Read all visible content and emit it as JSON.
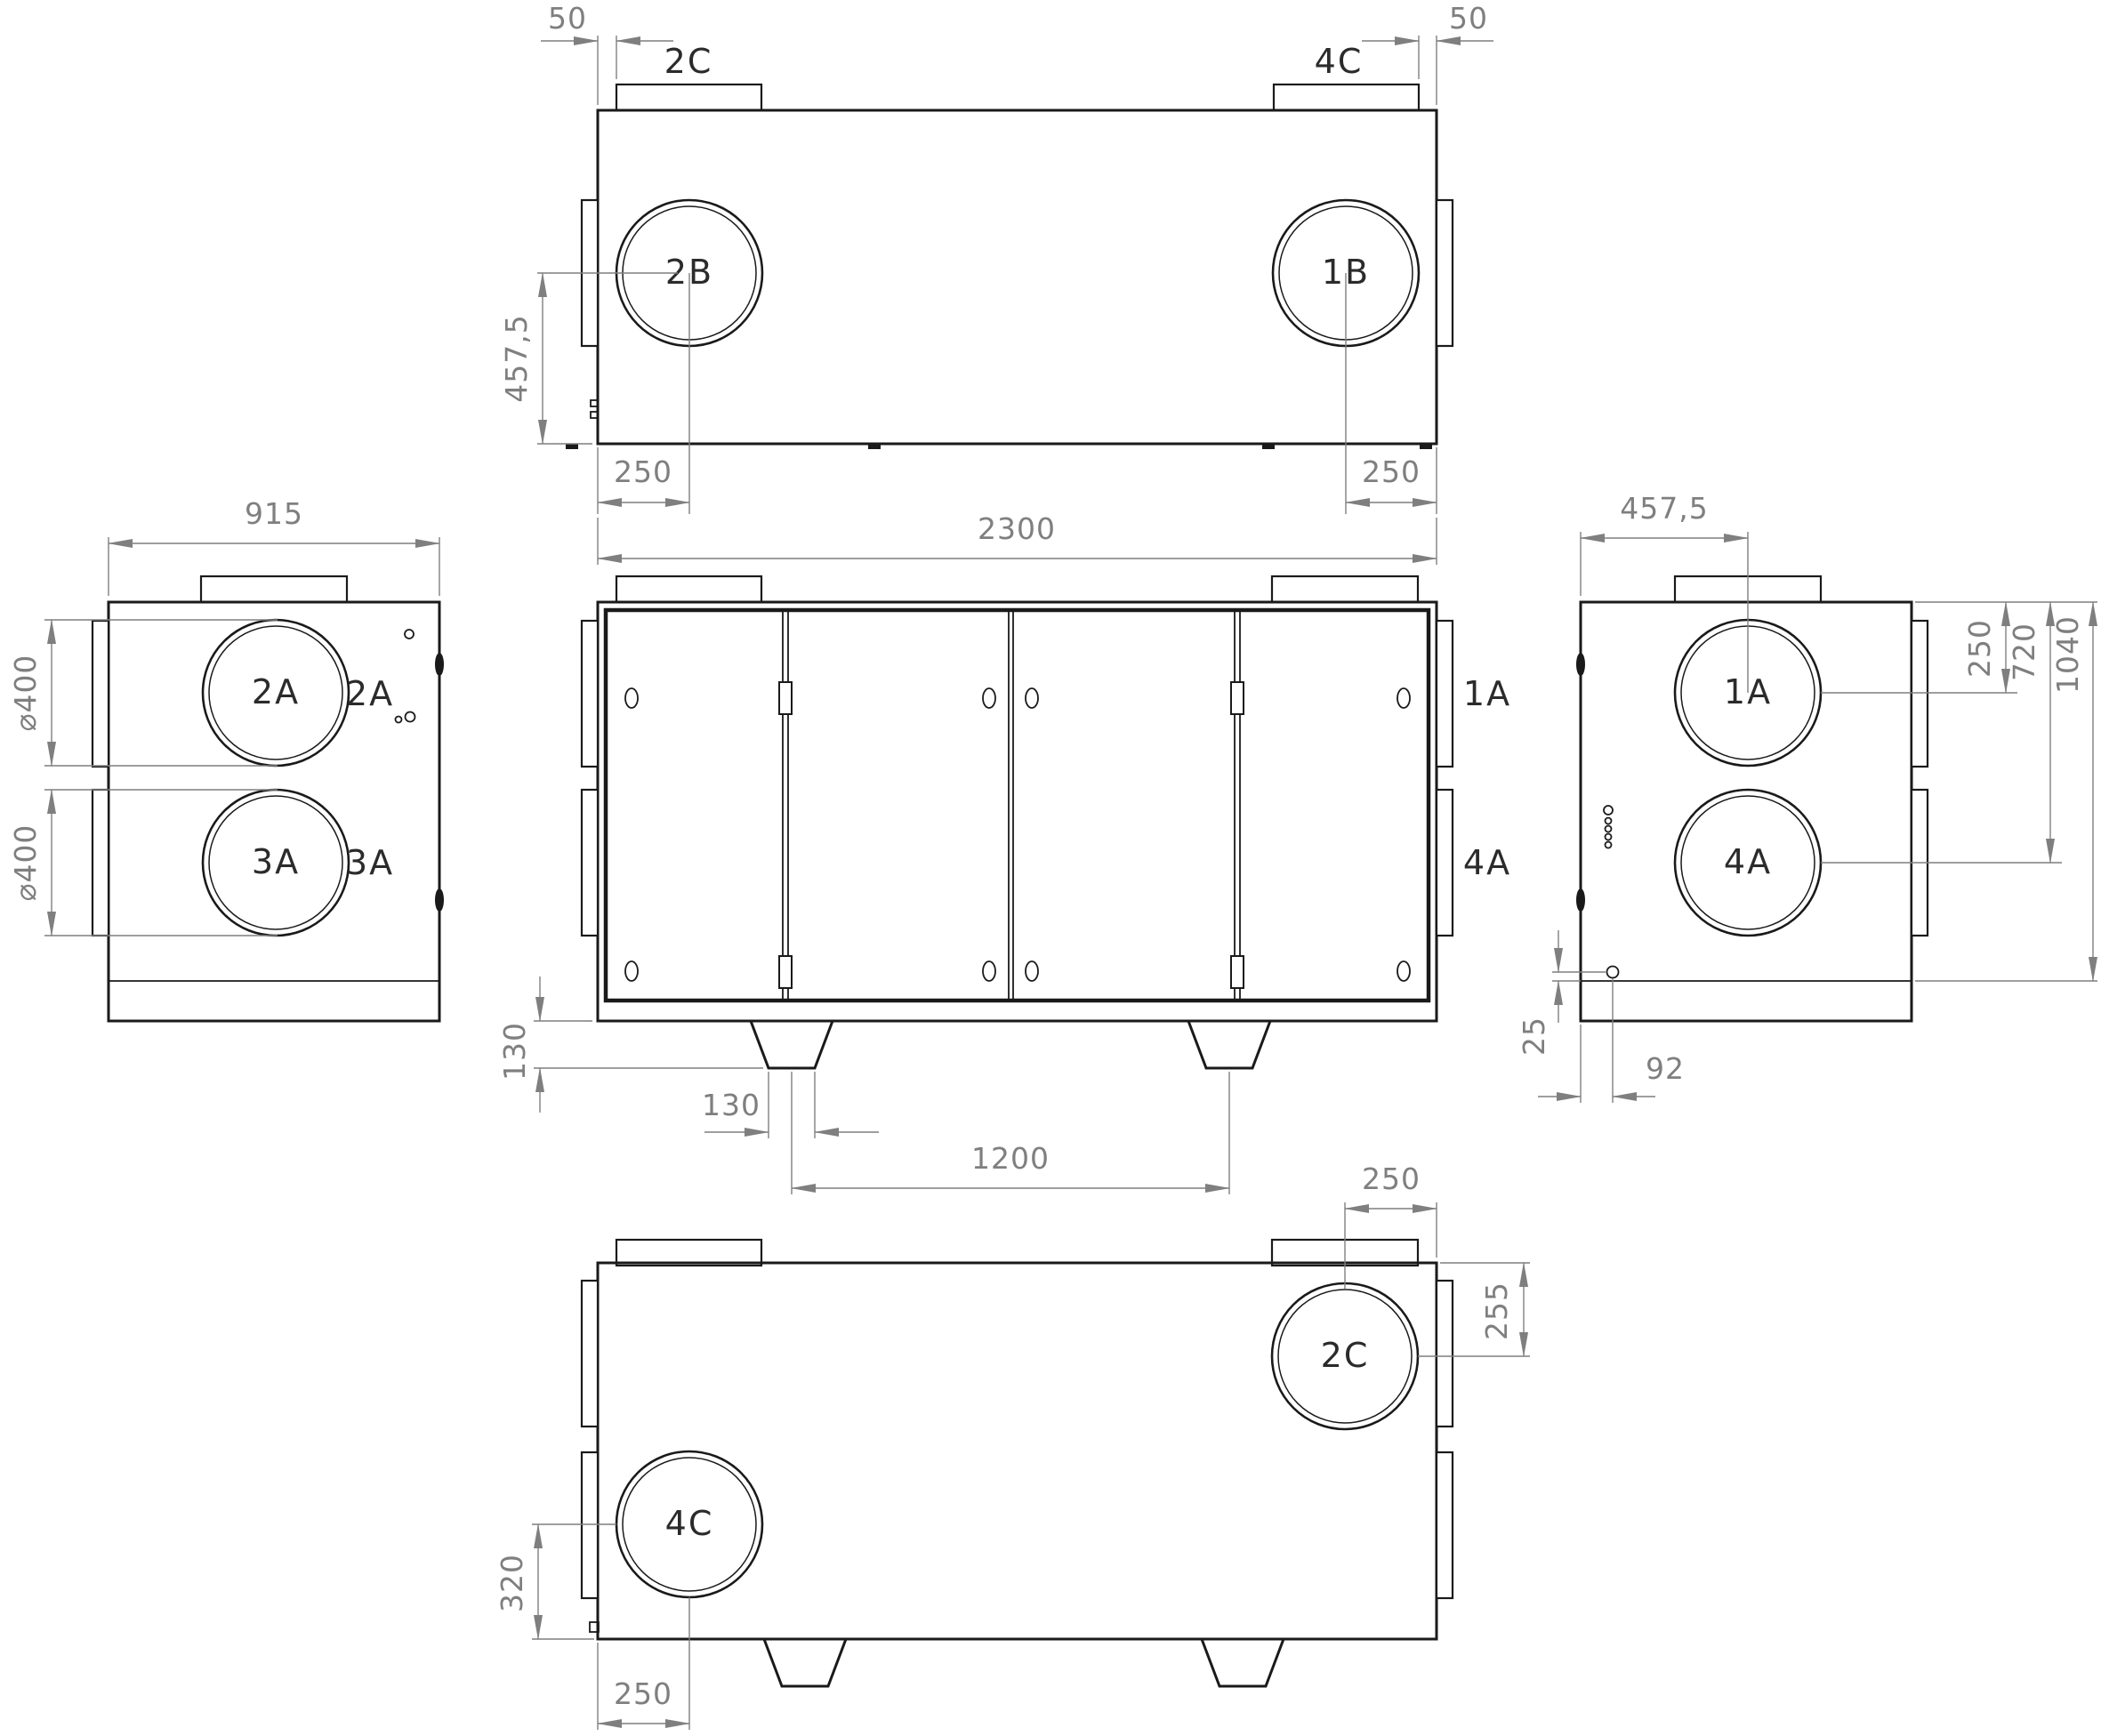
{
  "drawing": {
    "type": "engineering-dimension-drawing",
    "subject": "air-handling-unit",
    "colors": {
      "line_color": "#1a1a1a",
      "dim_color": "#7f7f7f",
      "background": "#ffffff"
    },
    "views": {
      "top": {
        "label_2c": "2C",
        "label_4c": "4C",
        "label_2b": "2B",
        "label_1b": "1B",
        "dim_offset_left": "50",
        "dim_offset_right": "50",
        "dim_depth_center": "457,5",
        "dim_port_left": "250",
        "dim_port_right": "250",
        "dim_length": "2300"
      },
      "left": {
        "label_2a": "2A",
        "label_3a": "3A",
        "dim_depth": "915",
        "dim_dia_top": "⌀400",
        "dim_dia_bottom": "⌀400"
      },
      "front": {
        "label_2a": "2A",
        "label_3a": "3A",
        "label_1a": "1A",
        "label_4a": "4A",
        "dim_foot_height": "130",
        "dim_foot_width": "130",
        "dim_foot_spacing": "1200"
      },
      "right": {
        "label_1a": "1A",
        "label_4a": "4A",
        "dim_depth_center": "457,5",
        "dim_port_top": "250",
        "dim_port_bottom": "720",
        "dim_height": "1040",
        "dim_gland_offset": "25",
        "dim_gland_x": "92"
      },
      "bottom": {
        "label_2c": "2C",
        "label_4c": "4C",
        "dim_port_right": "250",
        "dim_port_right_depth": "255",
        "dim_port_left_depth": "320",
        "dim_port_left": "250"
      }
    }
  }
}
